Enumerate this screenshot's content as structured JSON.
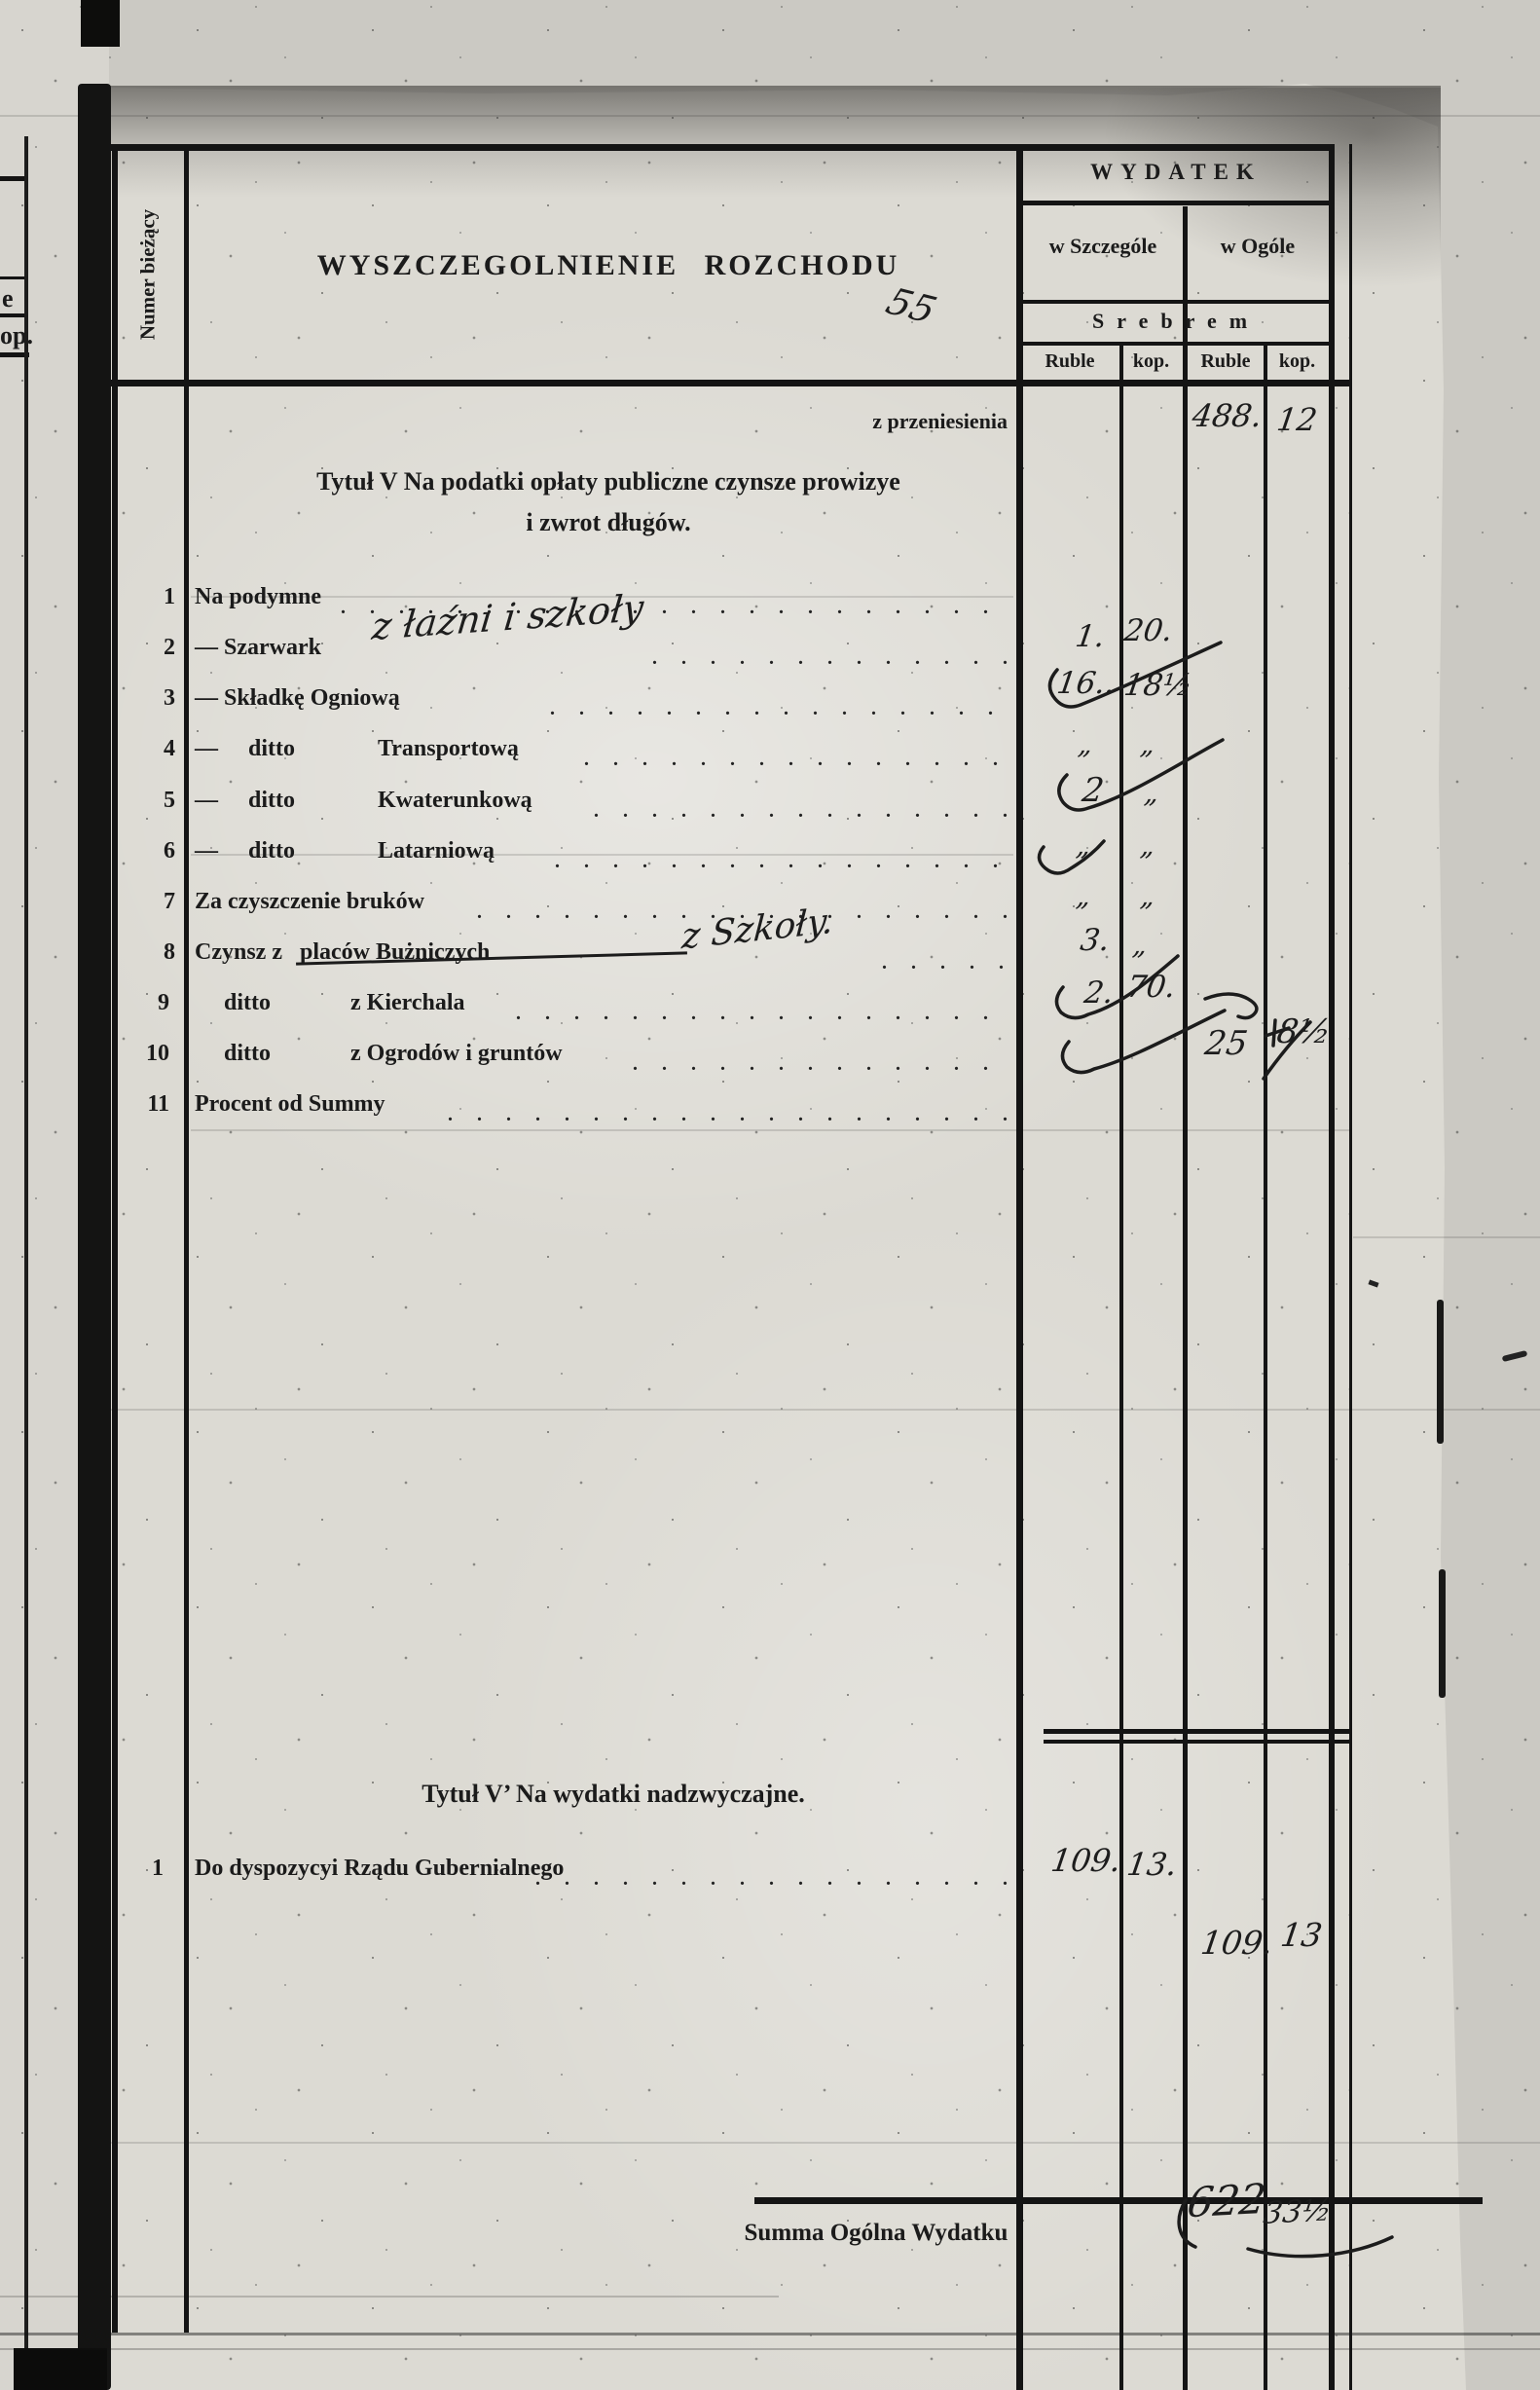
{
  "doc": {
    "margin": {
      "frag_e": "e",
      "frag_op": "op."
    },
    "numer_biezacy": "Numer bieżący",
    "title": "WYSZCZEGOLNIENIE ROZCHODU",
    "title_mark": "55",
    "header": {
      "wydatek": "WYDATEK",
      "w_szczegole": "w Szczególe",
      "w_ogole": "w Ogóle",
      "srebrem": "Srebrem",
      "ruble": "Ruble",
      "kop": "kop."
    },
    "leader_dots": ". . . . . . . . . . . . . . . . . . . . . . . . . . . . . . . . . . . . . . . . . . . . . . . .",
    "carryover": {
      "label": "z przeniesienia",
      "ruble": "488.",
      "kop": "12"
    },
    "s1": {
      "h1": "Tytuł V  Na podatki opłaty publiczne czynsze prowizye",
      "h2": "i zwrot długów.",
      "rows": [
        {
          "num": "1",
          "a": "Na podymne"
        },
        {
          "num": "2",
          "a": "— Szarwark",
          "hw": "z łaźni i szkoły",
          "sr": "1.",
          "sk": "20."
        },
        {
          "num": "3",
          "a": "— Składkę Ogniową",
          "sr": "16..",
          "sk": "18½"
        },
        {
          "num": "4",
          "a": "—",
          "b": "ditto",
          "c": "Transportową",
          "sr": "„",
          "sk": "„"
        },
        {
          "num": "5",
          "a": "—",
          "b": "ditto",
          "c": "Kwaterunkową",
          "sr": "2",
          "sk": "„"
        },
        {
          "num": "6",
          "a": "—",
          "b": "ditto",
          "c": "Latarniową",
          "sr": "„",
          "sk": "„"
        },
        {
          "num": "7",
          "a": "Za czyszczenie bruków",
          "sr": "„",
          "sk": "„"
        },
        {
          "num": "8",
          "a": "Czynsz z",
          "struck": "placów Bużniczych",
          "hw": "z Szkoły.",
          "sr": "3.",
          "sk": "„"
        },
        {
          "num": "9",
          "b": "ditto",
          "c": "z Kierchala",
          "sr": "2.",
          "sk": "70."
        },
        {
          "num": "10",
          "b": "ditto",
          "c": "z Ogrodów i gruntów",
          "or": "25",
          "ok": "8½"
        },
        {
          "num": "11",
          "a": "Procent od Summy"
        }
      ]
    },
    "s2": {
      "h": "Tytuł V’  Na wydatki nadzwyczajne.",
      "row": {
        "num": "1",
        "label": "Do dyspozycyi Rządu Gubernialnego",
        "ruble": "109.",
        "kop": "13."
      },
      "total": {
        "ruble": "109.",
        "kop": "13"
      }
    },
    "summary": {
      "label": "Summa Ogólna Wydatku",
      "ruble": "622",
      "kop": "33½"
    }
  }
}
